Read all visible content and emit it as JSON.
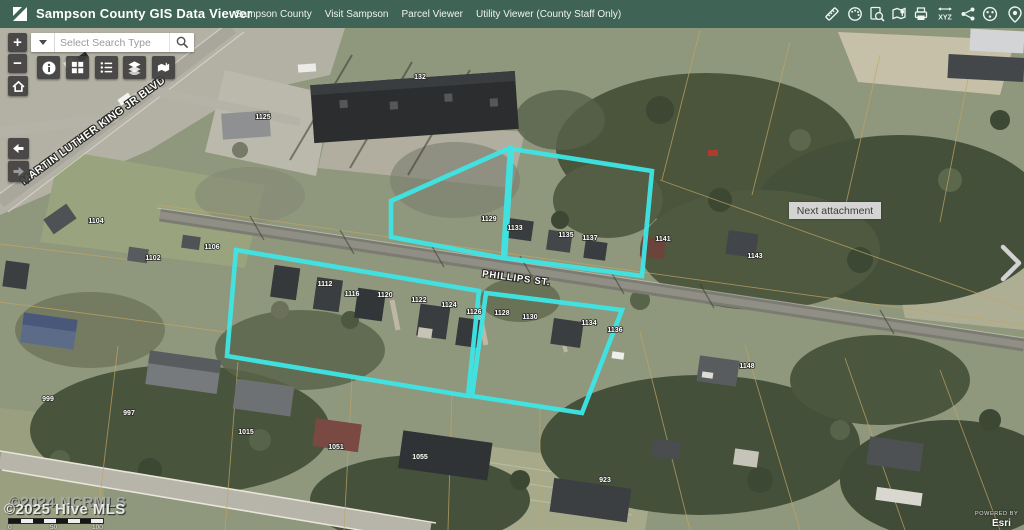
{
  "header": {
    "title": "Sampson County GIS Data Viewer",
    "nav": [
      {
        "label": "Sampson County"
      },
      {
        "label": "Visit Sampson"
      },
      {
        "label": "Parcel Viewer"
      },
      {
        "label": "Utility Viewer (County Staff Only)"
      }
    ],
    "tools": {
      "xyz_label": "XYZ",
      "icon_names": [
        "measure-icon",
        "draw-icon",
        "identify-icon",
        "bookmark-map-icon",
        "print-icon",
        "coordinates-xyz-icon",
        "share-icon",
        "basemap-globe-icon",
        "locate-pin-icon"
      ]
    }
  },
  "search": {
    "placeholder": "Select Search Type"
  },
  "map_controls": {
    "zoom_in": "+",
    "zoom_out": "−"
  },
  "panels": {
    "next_attachment": "Next attachment"
  },
  "colors": {
    "header": "#3F6354",
    "highlight": "#3EE6E6",
    "parcel_line": "#C2A565"
  },
  "map": {
    "street_labels": [
      {
        "text": "MARTIN LUTHER KING JR BLVD"
      },
      {
        "text": "PHILLIPS ST."
      }
    ],
    "parcel_labels": [
      {
        "text": "132"
      },
      {
        "text": "1125"
      },
      {
        "text": "1104"
      },
      {
        "text": "1102"
      },
      {
        "text": "1106"
      },
      {
        "text": "1129"
      },
      {
        "text": "1133"
      },
      {
        "text": "1135"
      },
      {
        "text": "1137"
      },
      {
        "text": "1141"
      },
      {
        "text": "1143"
      },
      {
        "text": "1148"
      },
      {
        "text": "1112"
      },
      {
        "text": "1116"
      },
      {
        "text": "1120"
      },
      {
        "text": "1122"
      },
      {
        "text": "1124"
      },
      {
        "text": "1126"
      },
      {
        "text": "1128"
      },
      {
        "text": "1130"
      },
      {
        "text": "1134"
      },
      {
        "text": "1136"
      },
      {
        "text": "999"
      },
      {
        "text": "997"
      },
      {
        "text": "1015"
      },
      {
        "text": "1051"
      },
      {
        "text": "1055"
      },
      {
        "text": "923"
      }
    ],
    "watermarks": {
      "back": "©2024 NCRMLS",
      "front": "©2025 Hive MLS"
    },
    "scale": {
      "labels": [
        "0",
        "50",
        "100"
      ]
    },
    "attribution": {
      "powered_by": "POWERED BY",
      "brand": "Esri"
    }
  }
}
